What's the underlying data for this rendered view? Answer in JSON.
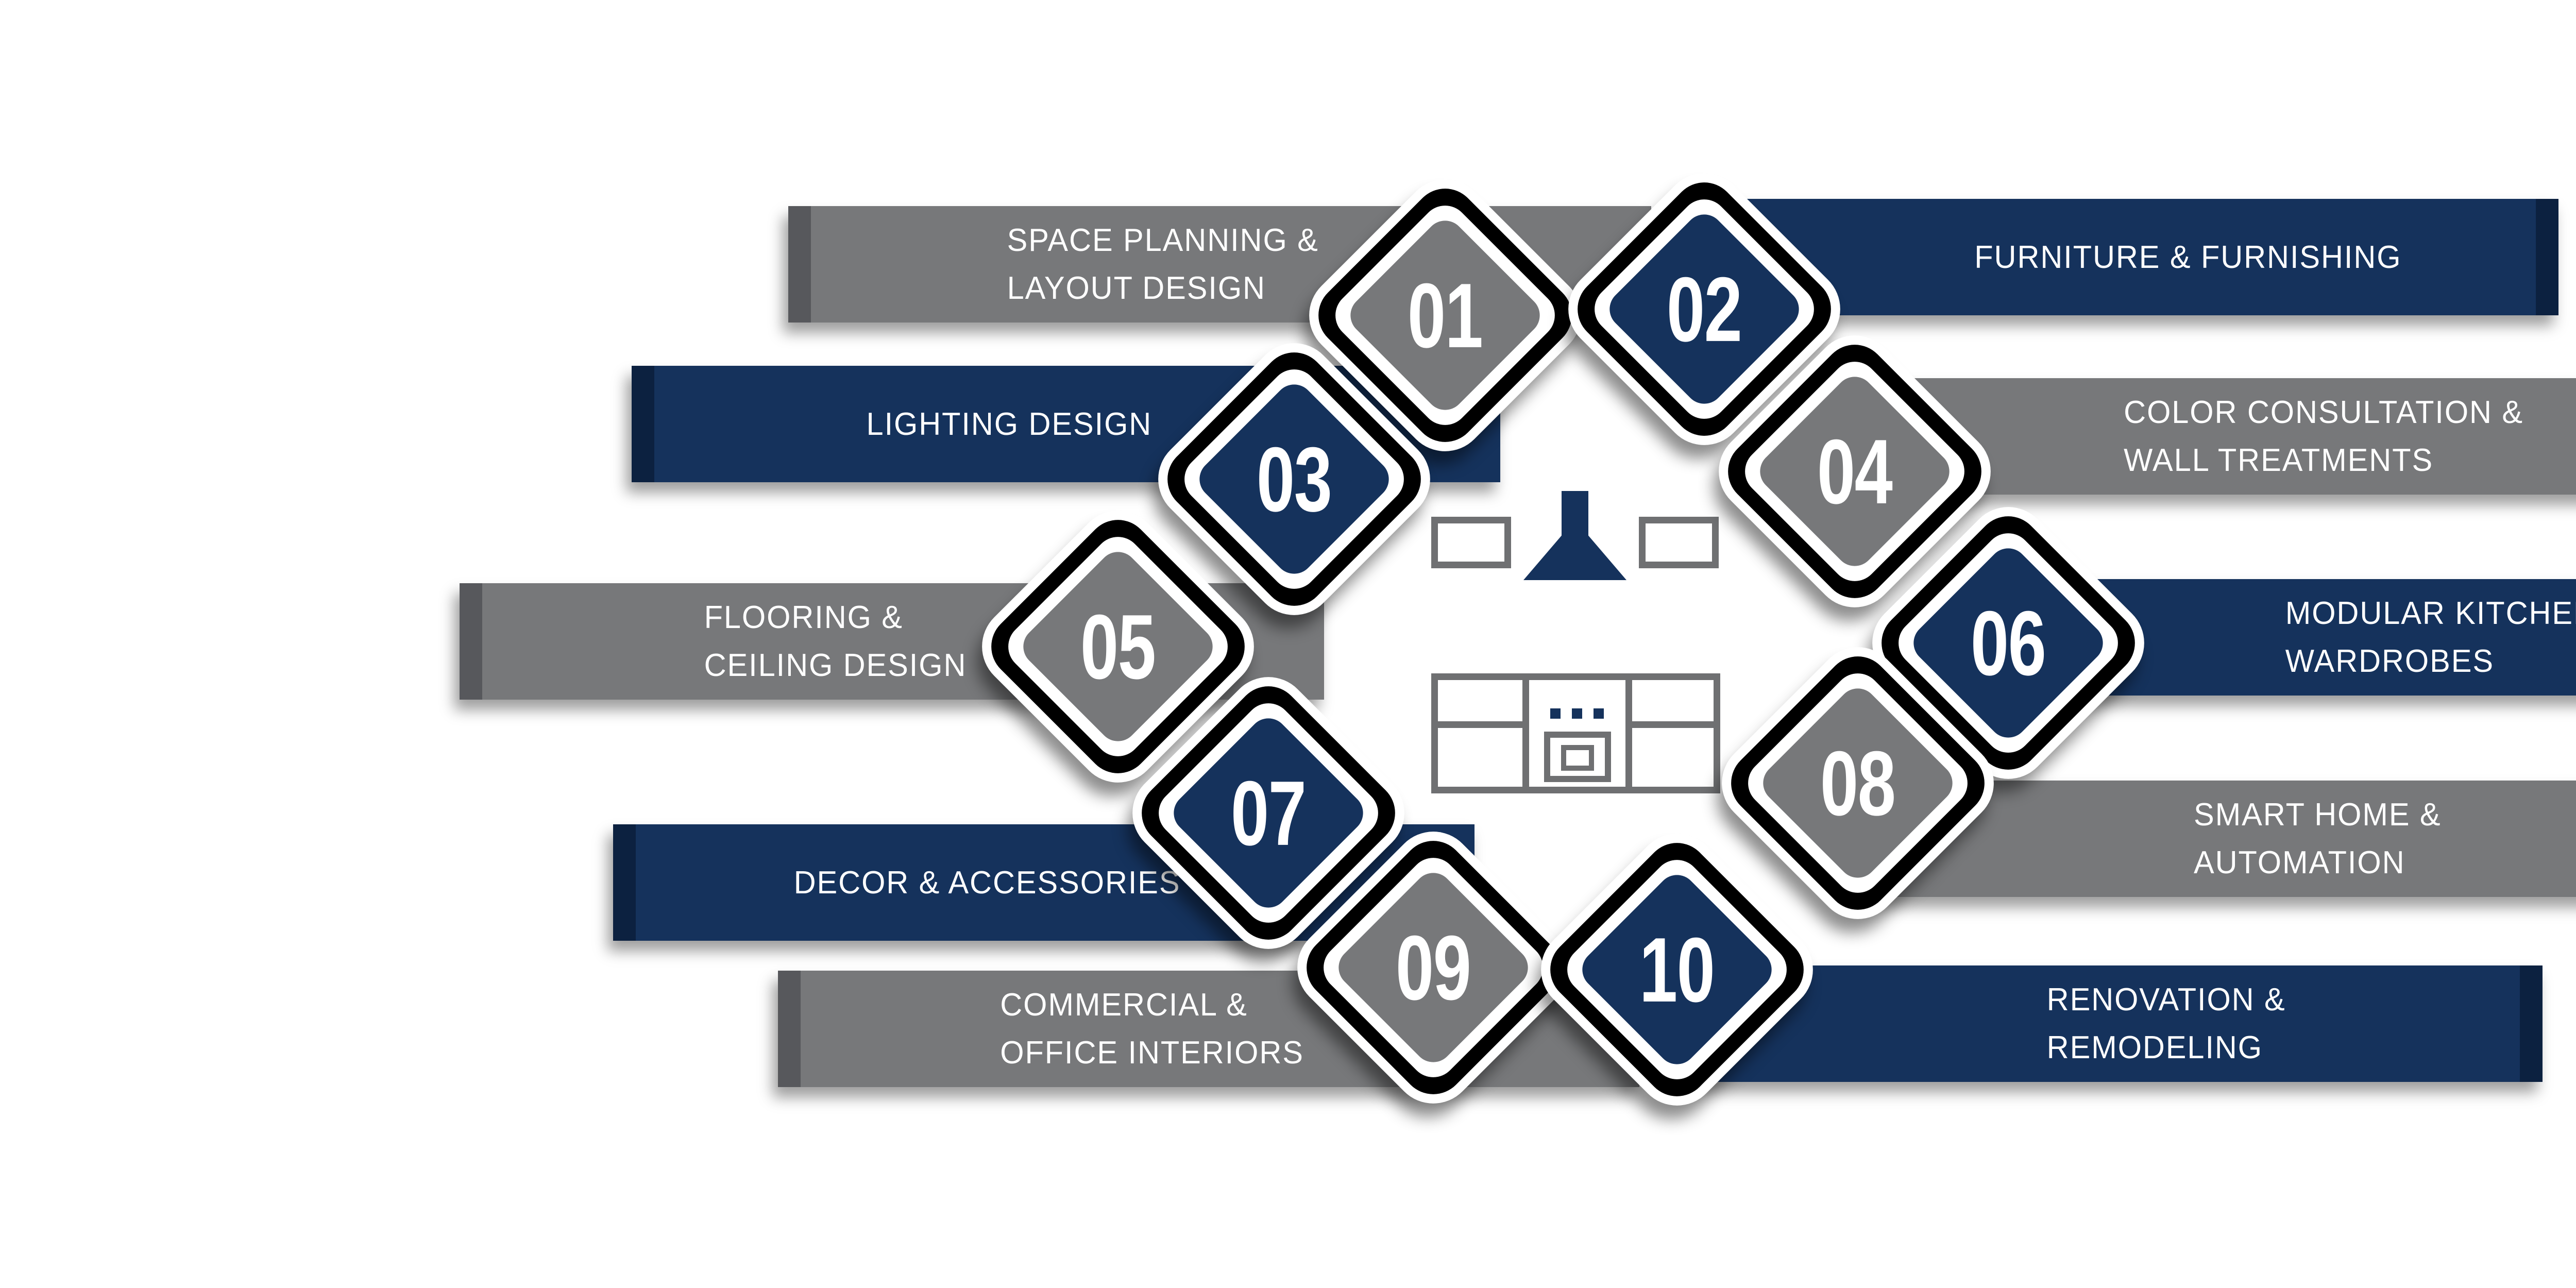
{
  "colors": {
    "navy": "#15325c",
    "navy_dark": "#0c2140",
    "gray": "#77787a",
    "gray_dark": "#57585c",
    "outline_black": "#000000",
    "icon_stroke": "#6f7072",
    "text": "#ffffff"
  },
  "center_icon": "kitchen-stove-hood-icon",
  "items": [
    {
      "number": "01",
      "label": "SPACE PLANNING &\nLAYOUT DESIGN",
      "side": "left",
      "theme": "gray"
    },
    {
      "number": "02",
      "label": "FURNITURE & FURNISHING",
      "side": "right",
      "theme": "navy"
    },
    {
      "number": "03",
      "label": "LIGHTING DESIGN",
      "side": "left",
      "theme": "navy"
    },
    {
      "number": "04",
      "label": "COLOR CONSULTATION &\nWALL TREATMENTS",
      "side": "right",
      "theme": "gray"
    },
    {
      "number": "05",
      "label": "FLOORING &\nCEILING DESIGN",
      "side": "left",
      "theme": "gray"
    },
    {
      "number": "06",
      "label": "MODULAR KITCHENS &\nWARDROBES",
      "side": "right",
      "theme": "navy"
    },
    {
      "number": "07",
      "label": "DECOR & ACCESSORIES",
      "side": "left",
      "theme": "navy"
    },
    {
      "number": "08",
      "label": "SMART HOME &\nAUTOMATION",
      "side": "right",
      "theme": "gray"
    },
    {
      "number": "09",
      "label": "COMMERCIAL &\nOFFICE INTERIORS",
      "side": "left",
      "theme": "gray"
    },
    {
      "number": "10",
      "label": "RENOVATION &\nREMODELING",
      "side": "right",
      "theme": "navy"
    }
  ]
}
